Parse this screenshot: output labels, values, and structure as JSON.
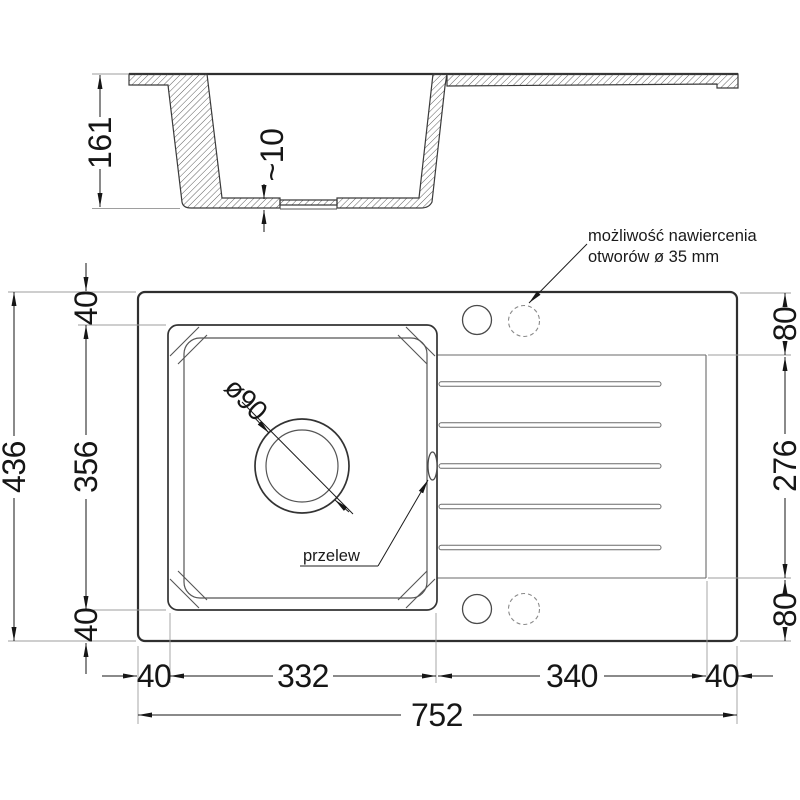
{
  "section_view": {
    "height": "161",
    "bottom_thickness": "~10"
  },
  "plan_view": {
    "dimensions": {
      "left_total": "436",
      "left_top": "40",
      "left_bowl": "356",
      "left_bottom": "40",
      "right_top": "80",
      "right_drainboard": "276",
      "right_bottom": "80",
      "bottom_left_margin": "40",
      "bottom_bowl": "332",
      "bottom_drainboard": "340",
      "bottom_right_margin": "40",
      "bottom_total": "752"
    },
    "labels": {
      "drain_diameter": "ø90",
      "overflow": "przelew",
      "drill_note_line1": "możliwość nawiercenia",
      "drill_note_line2": "otworów ø 35 mm"
    }
  },
  "colors": {
    "background": "#ffffff",
    "line": "#2f2f2f",
    "dimension": "#161616",
    "extension": "#9e9e9e",
    "hatch": "#5f5f5f",
    "dashed_hole": "#8a8a8a"
  }
}
